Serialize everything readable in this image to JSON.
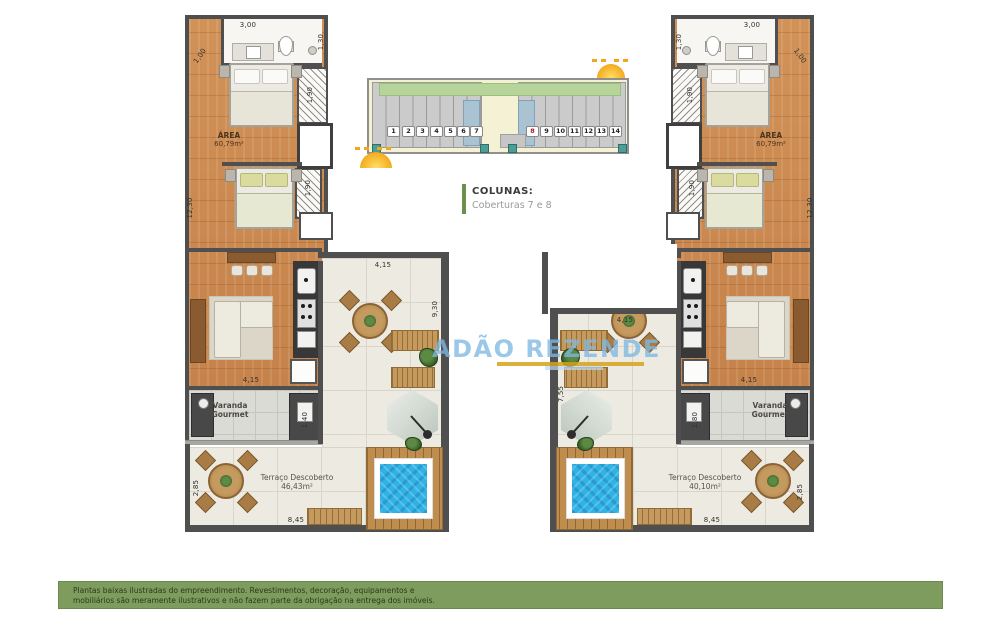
{
  "page": {
    "background": "#ffffff"
  },
  "keyplan": {
    "numbers": [
      "1",
      "2",
      "3",
      "4",
      "5",
      "6",
      "7",
      "8",
      "9",
      "10",
      "11",
      "12",
      "13",
      "14"
    ],
    "highlighted_units": [
      "7",
      "8"
    ],
    "highlight_color": "#a9c3d2"
  },
  "legend": {
    "title": "COLUNAS:",
    "subtitle": "Coberturas 7 e 8",
    "accent_color": "#6f8f4f"
  },
  "watermark": {
    "text": "ADÃO REZENDE",
    "color": "#7fb9e2",
    "underline_color": "#d6a21c"
  },
  "units": {
    "left": {
      "area_label": "ÁREA",
      "area_value": "60,79m²",
      "varanda_label": "Varanda Gourmet",
      "terrace_label": "Terraço Descoberto",
      "terrace_value": "46,43m²",
      "dims": {
        "bath_width": "3,00",
        "bath_depth": "1,30",
        "entry": "1,00",
        "side": "12,30",
        "closet1": "1,90",
        "closet2": "1,90",
        "living": "4,15",
        "varanda_side": "1,40",
        "terrace_top": "4,15",
        "terrace_side": "9,30",
        "descoberto_width": "8,45",
        "descoberto_side": "2,85"
      }
    },
    "right": {
      "area_label": "ÁREA",
      "area_value": "60,79m²",
      "varanda_label": "Varanda Gourmet",
      "terrace_label": "Terraço Descoberto",
      "terrace_value": "40,10m²",
      "dims": {
        "bath_width": "3,00",
        "bath_depth": "1,30",
        "entry": "1,00",
        "side": "12,30",
        "closet1": "1,90",
        "closet2": "1,90",
        "living": "4,15",
        "varanda_side": "1,80",
        "terrace_top": "4,15",
        "terrace_side": "7,55",
        "descoberto_width": "8,45",
        "descoberto_side": "2,85"
      }
    }
  },
  "footer": {
    "line1": "Plantas baixas ilustradas do empreendimento. Revestimentos, decoração, equipamentos e",
    "line2": "mobiliários são meramente ilustrativos e não fazem parte da obrigação na entrega dos imóveis.",
    "background": "#7e9c5e"
  }
}
